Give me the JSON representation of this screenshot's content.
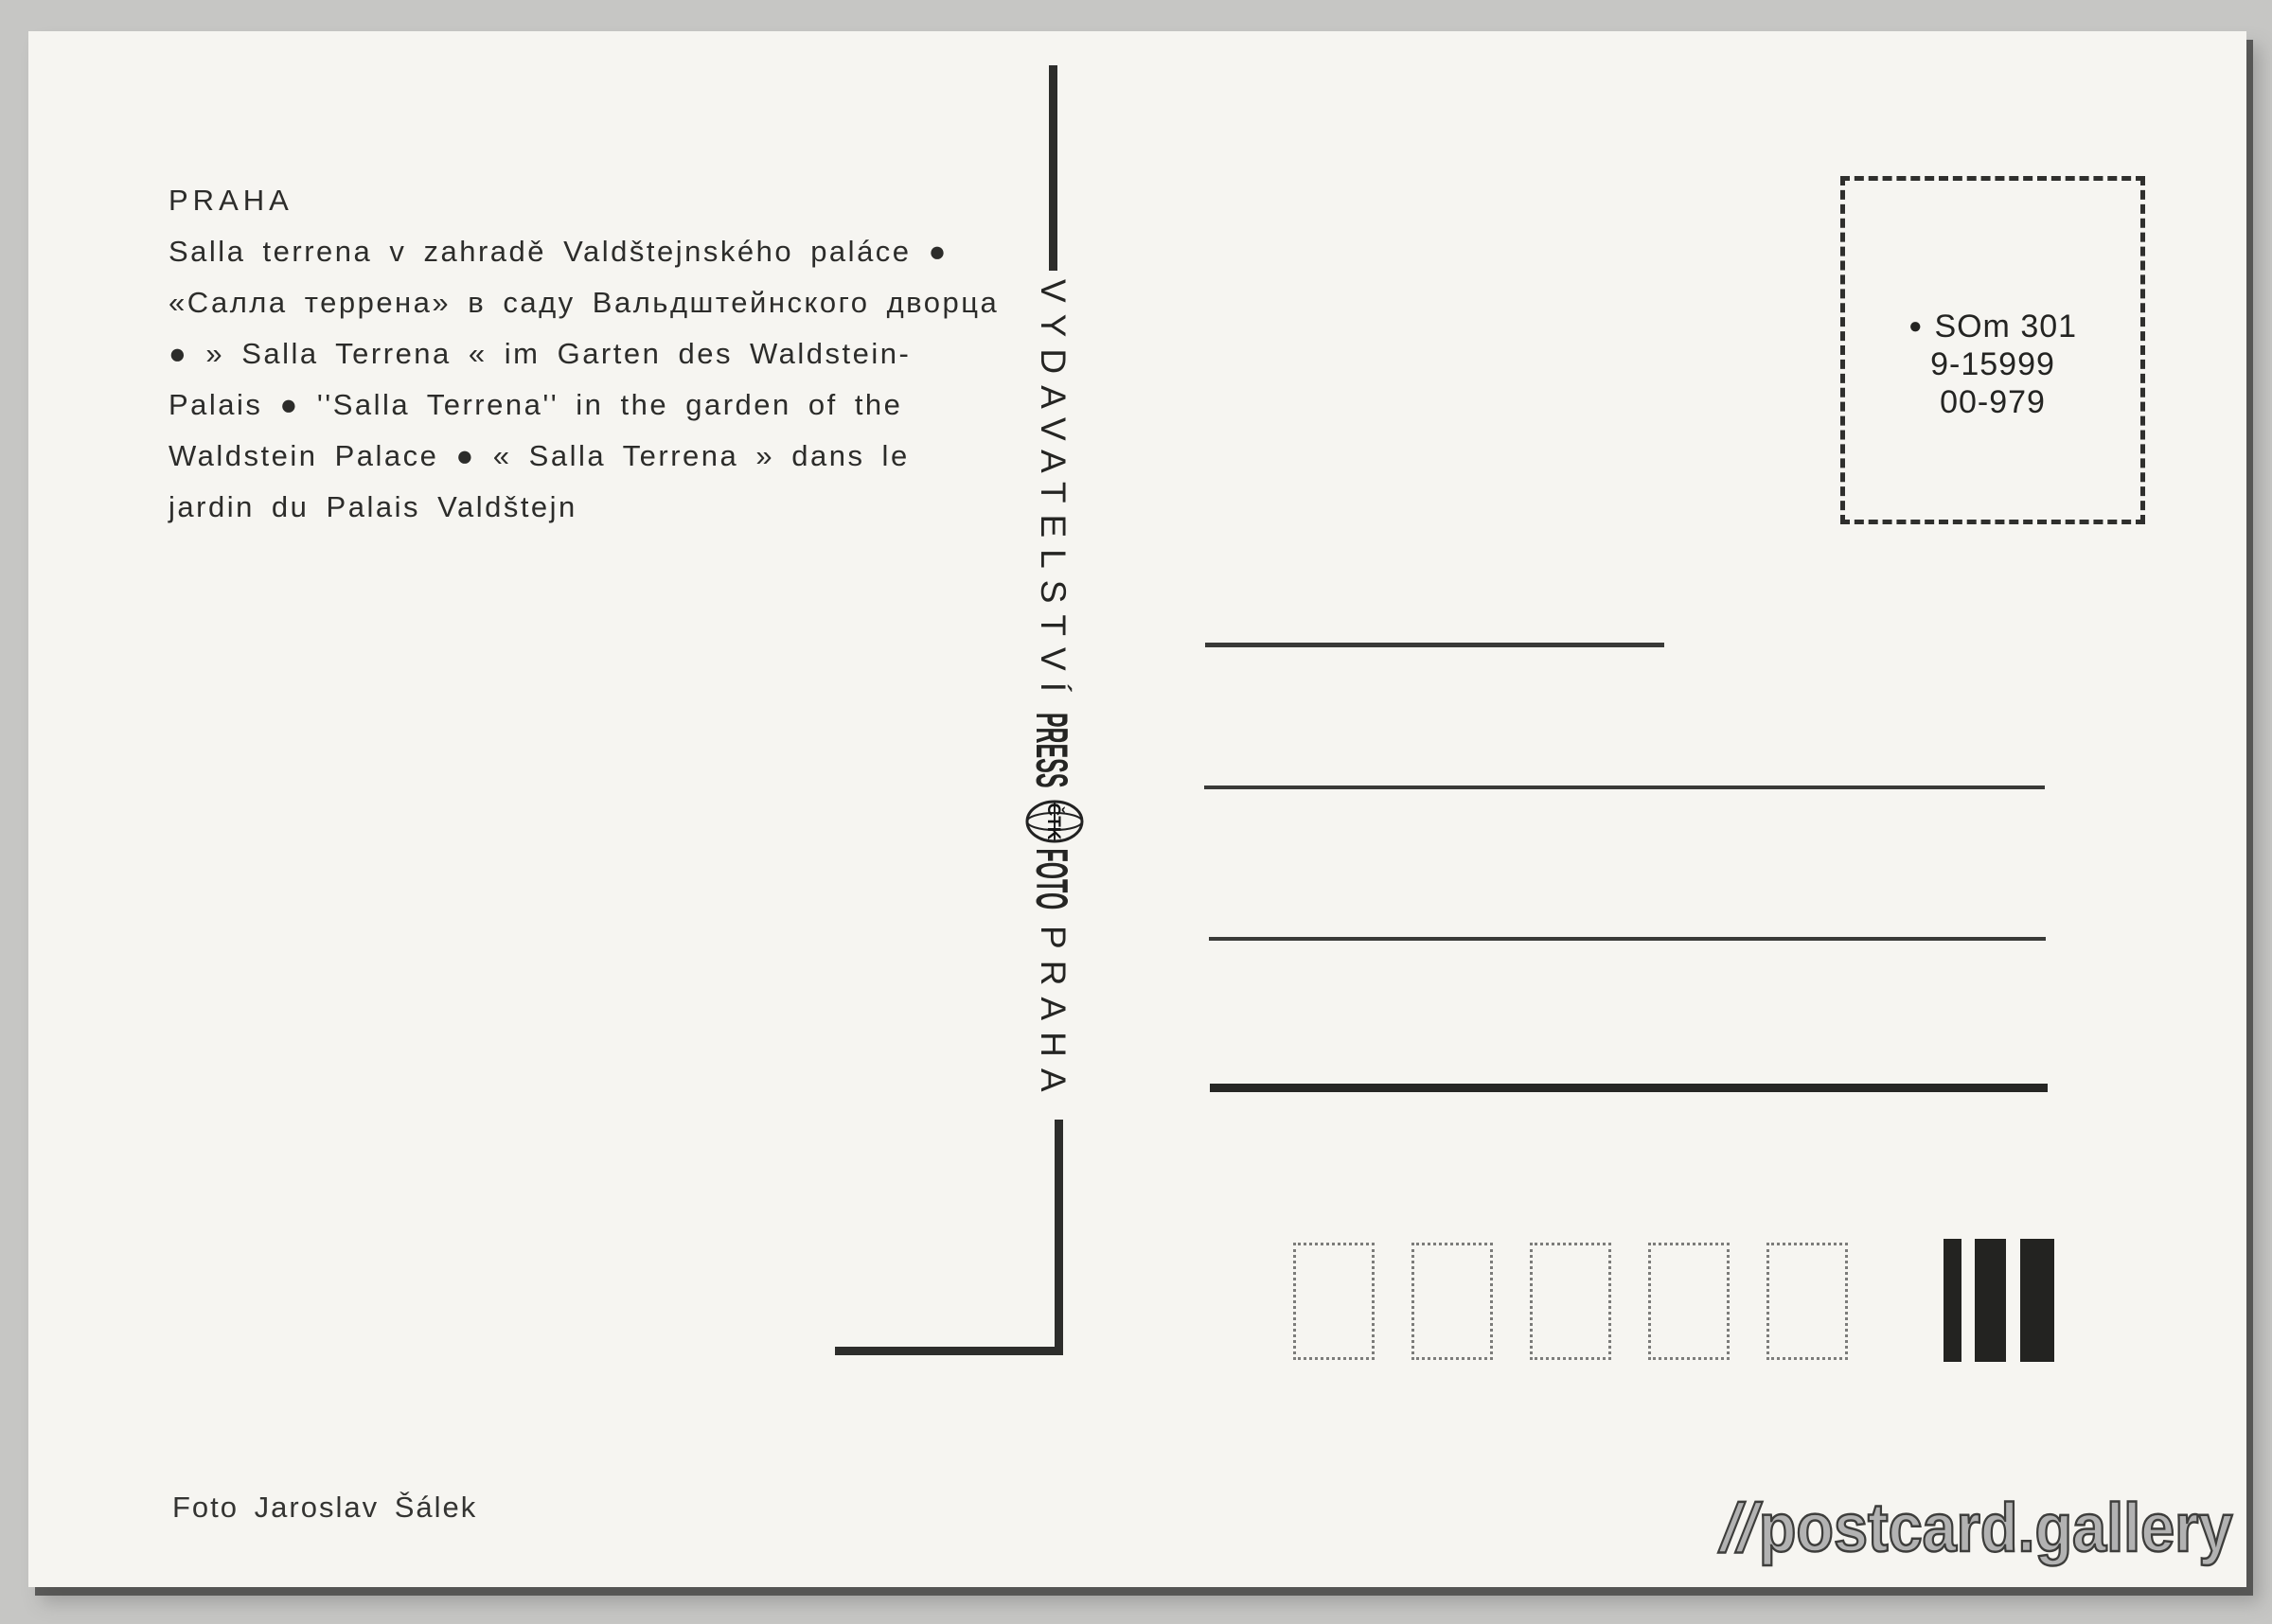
{
  "postcard": {
    "heading": "PRAHA",
    "caption_lines": [
      "Salla terrena v zahradě Valdštejnského paláce ●",
      "«Салла террена» в саду Вальдштейнского дворца",
      "● » Salla Terrena « im Garten des Waldstein-",
      "Palais ● ''Salla Terrena'' in the garden of the",
      "Waldstein Palace ● « Salla Terrena » dans le",
      "jardin du Palais Valdštejn"
    ],
    "spine": {
      "vydavatelstvi": "VYDAVATELSTVÍ",
      "press": "PRESS",
      "ctk": "ČTK",
      "foto": "FOTO",
      "praha": "PRAHA"
    },
    "stamp_box": {
      "bullet": "●",
      "line1": "SOm 301",
      "line2": "9-15999",
      "line3": "00-979"
    },
    "photo_credit": "Foto Jaroslav Šálek"
  },
  "watermark": {
    "slashes": "//",
    "name": "postcard.gallery"
  },
  "colors": {
    "paper": "#f6f5f1",
    "ink": "#2c2c2a",
    "scan_background": "#c6c6c4"
  }
}
